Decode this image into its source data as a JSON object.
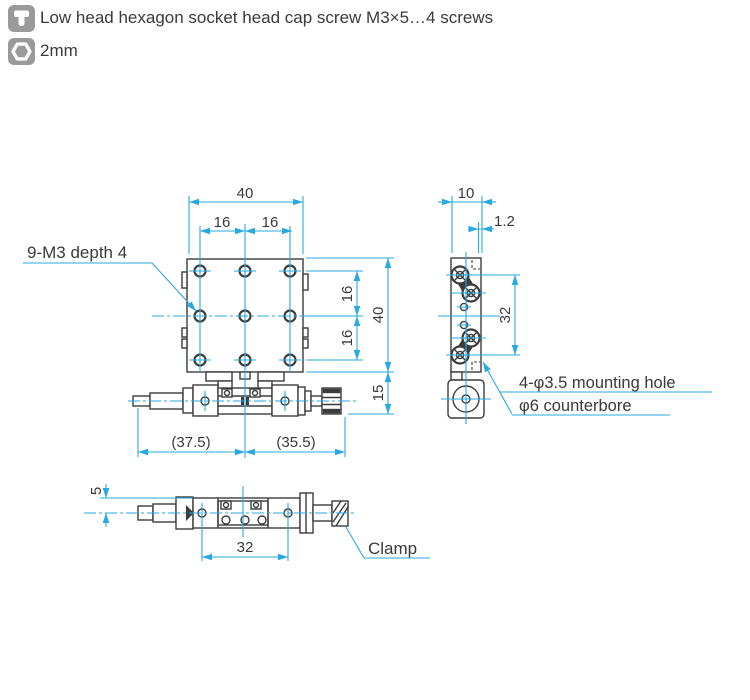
{
  "header": {
    "screw_note": "Low head hexagon socket head cap screw M3×5…4 screws",
    "wrench_size": "2mm"
  },
  "colors": {
    "dimension_blue": "#29A9E1",
    "line_dark": "#3C3C3C",
    "icon_gray": "#9A9A9A",
    "text_dark": "#3A3A3A"
  },
  "front_view": {
    "label_holes": "9-M3 depth 4",
    "dim_top_width": "40",
    "dim_top_pitch_left": "16",
    "dim_top_pitch_right": "16",
    "dim_right_pitch_upper": "16",
    "dim_right_pitch_lower": "16",
    "dim_right_height": "40",
    "dim_right_knob_drop": "15",
    "dim_bottom_left": "(37.5)",
    "dim_bottom_right": "(35.5)"
  },
  "side_view": {
    "dim_top_depth": "10",
    "dim_top_lip": "1.2",
    "dim_hole_pitch": "32",
    "note_line1": "4-φ3.5 mounting hole",
    "note_line2": "φ6 counterbore"
  },
  "bottom_view": {
    "dim_left_height": "5",
    "dim_hole_pitch": "32",
    "label_clamp": "Clamp"
  }
}
